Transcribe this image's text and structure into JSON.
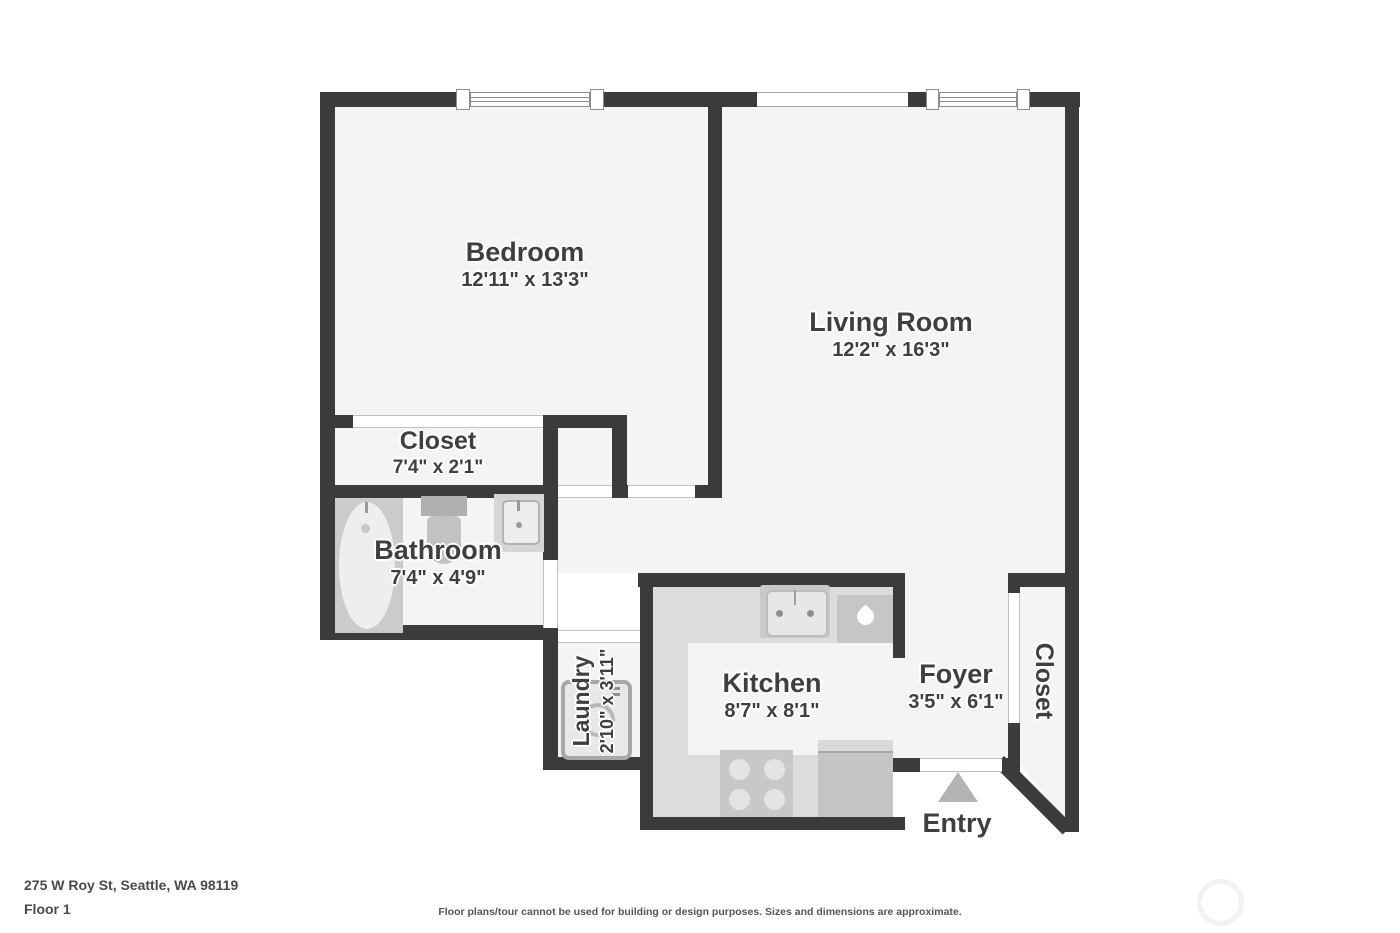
{
  "floor_plan": {
    "colors": {
      "wall": "#3b3b3b",
      "floor": "#f4f4f4",
      "counter": "#dcdcdc",
      "fixture": "#c6c6c6",
      "entry_arrow": "#b3b3b3",
      "label_text": "#3f3f3f"
    },
    "rooms": {
      "bedroom": {
        "name": "Bedroom",
        "dimensions": "12'11\" x 13'3\""
      },
      "living_room": {
        "name": "Living Room",
        "dimensions": "12'2\" x 16'3\""
      },
      "bedroom_closet": {
        "name": "Closet",
        "dimensions": "7'4\" x 2'1\""
      },
      "bathroom": {
        "name": "Bathroom",
        "dimensions": "7'4\" x 4'9\""
      },
      "laundry": {
        "name": "Laundry",
        "dimensions": "2'10\" x 3'11\""
      },
      "kitchen": {
        "name": "Kitchen",
        "dimensions": "8'7\" x 8'1\""
      },
      "foyer": {
        "name": "Foyer",
        "dimensions": "3'5\" x 6'1\""
      },
      "entry_closet": {
        "name": "Closet"
      },
      "entry": {
        "label": "Entry"
      }
    }
  },
  "footer": {
    "address": "275 W Roy St, Seattle, WA 98119",
    "floor_label": "Floor 1",
    "disclaimer": "Floor plans/tour cannot be used for building or design purposes. Sizes and dimensions are approximate."
  }
}
